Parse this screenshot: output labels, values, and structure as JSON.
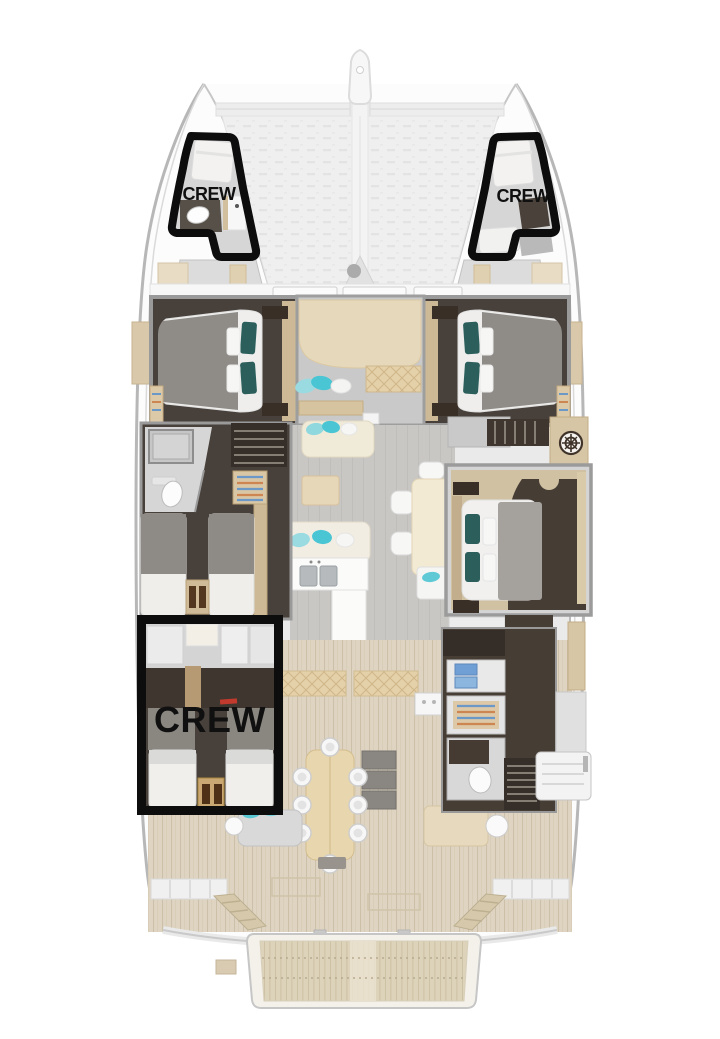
{
  "page": {
    "description": "Catamaran yacht deck floor plan with highlighted crew areas",
    "view": "top-down deck plan"
  },
  "labels": {
    "crew_bow_port": "CREW",
    "crew_bow_starboard": "CREW",
    "crew_aft": "CREW"
  },
  "colors": {
    "crew_highlight_outline": "#0d0d0d",
    "crew_label_text": "#101010",
    "teak_deck": "#ded4c1",
    "swim_platform_teak": "#ddd3ba",
    "dark_cabin_floor": "#48403a",
    "wood_trim": "#cdb995",
    "quilted_seat": "#e4d0a9",
    "sofa_cream": "#f0ead9",
    "pillow_teal_light": "#49c5d4",
    "pillow_teal_dark": "#2c5f5c",
    "bed_duvet_gray": "#8f8c88",
    "hull_outline": "#b7b7b7",
    "trampoline": "#efefef",
    "alert_red_marker": "#c23a2e"
  }
}
